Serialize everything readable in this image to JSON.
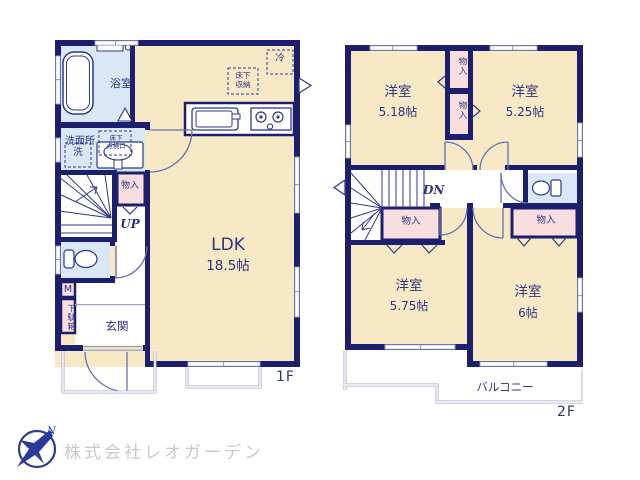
{
  "company": {
    "name": "株式会社レオガーデン",
    "compass_n": "N"
  },
  "colors": {
    "wall": "#1c1f6d",
    "room_floor": "#f8e9c6",
    "closet_pink": "#f8dede",
    "wet_blue": "#d9e7f6",
    "text_navy": "#2b3580",
    "thin_line": "#9aa2c4",
    "logo_blue": "#2b3a9a",
    "company_text": "#c9c9c9"
  },
  "floors": {
    "f1": {
      "label": "1F",
      "bath": "浴室",
      "washroom": "洗面所",
      "laundry": "洗",
      "hatch_l1": "床下",
      "hatch_l2": "点検口",
      "storage_l1": "床下",
      "storage_l2": "収納",
      "fridge": "冷",
      "closet": "物入",
      "up": "UP",
      "meter": "M",
      "shoebox": "下駄箱",
      "entrance": "玄関",
      "ldk_name": "LDK",
      "ldk_size": "18.5帖"
    },
    "f2": {
      "label": "2F",
      "r1_name": "洋室",
      "r1_size": "5.18帖",
      "r2_name": "洋室",
      "r2_size": "5.25帖",
      "r3_name": "洋室",
      "r3_size": "5.75帖",
      "r4_name": "洋室",
      "r4_size": "6帖",
      "closet1": "物入",
      "closet2": "物入",
      "closet3": "物入",
      "closet4": "物入",
      "dn": "DN",
      "balcony": "バルコニー"
    }
  }
}
